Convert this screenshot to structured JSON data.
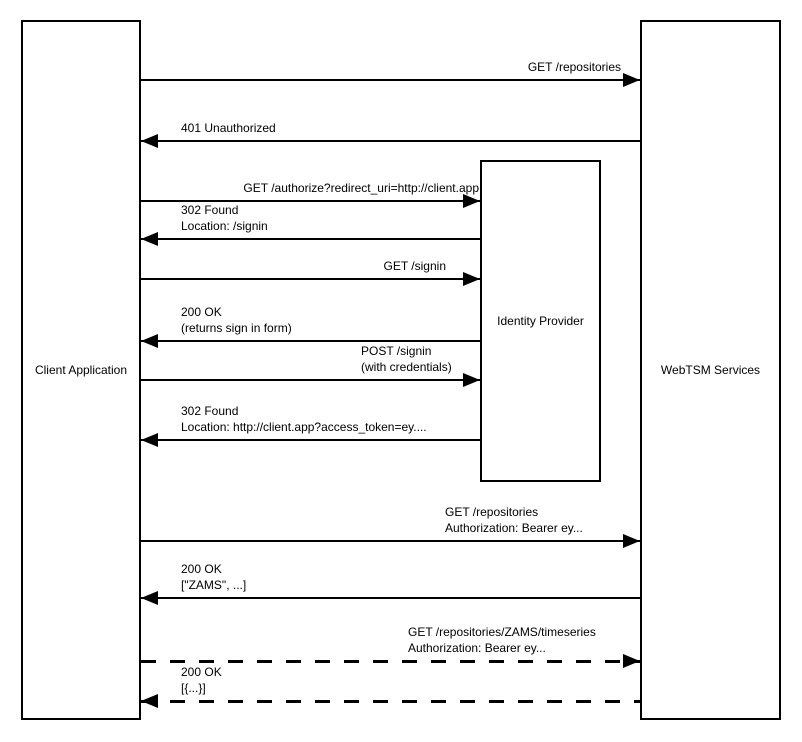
{
  "canvas": {
    "width": 802,
    "height": 742,
    "background": "#ffffff",
    "line_color": "#000000",
    "text_color": "#000000"
  },
  "diagram": {
    "type": "sequence",
    "actors": [
      {
        "id": "client-application",
        "label": "Client Application",
        "x": 21,
        "y": 20,
        "w": 120,
        "h": 700
      },
      {
        "id": "identity-provider",
        "label": "Identity Provider",
        "x": 480,
        "y": 160,
        "w": 121,
        "h": 322
      },
      {
        "id": "webtsm-services",
        "label": "WebTSM Services",
        "x": 640,
        "y": 20,
        "w": 141,
        "h": 700
      }
    ],
    "messages": [
      {
        "from": "client-application",
        "to": "webtsm-services",
        "lines": [
          "GET /repositories"
        ],
        "y": 80,
        "x1": 141,
        "x2": 640,
        "dir": "right",
        "style": "solid",
        "align": "right",
        "label_x": 621
      },
      {
        "from": "webtsm-services",
        "to": "client-application",
        "lines": [
          "401 Unauthorized"
        ],
        "y": 141,
        "x1": 141,
        "x2": 640,
        "dir": "left",
        "style": "solid",
        "align": "left",
        "label_x": 181
      },
      {
        "from": "client-application",
        "to": "identity-provider",
        "lines": [
          "GET /authorize?redirect_uri=http://client.app"
        ],
        "y": 201,
        "x1": 141,
        "x2": 480,
        "dir": "right",
        "style": "solid",
        "align": "right",
        "label_x": 479
      },
      {
        "from": "identity-provider",
        "to": "client-application",
        "lines": [
          "302 Found",
          "Location: /signin"
        ],
        "y": 239,
        "x1": 141,
        "x2": 480,
        "dir": "left",
        "style": "solid",
        "align": "left",
        "label_x": 181
      },
      {
        "from": "client-application",
        "to": "identity-provider",
        "lines": [
          "GET /signin"
        ],
        "y": 279,
        "x1": 141,
        "x2": 480,
        "dir": "right",
        "style": "solid",
        "align": "right",
        "label_x": 446
      },
      {
        "from": "identity-provider",
        "to": "client-application",
        "lines": [
          "200 OK",
          "(returns sign in form)"
        ],
        "y": 341,
        "x1": 141,
        "x2": 480,
        "dir": "left",
        "style": "solid",
        "align": "left",
        "label_x": 181
      },
      {
        "from": "client-application",
        "to": "identity-provider",
        "lines": [
          "POST /signin",
          "(with credentials)"
        ],
        "y": 380,
        "x1": 141,
        "x2": 480,
        "dir": "right",
        "style": "solid",
        "align": "left",
        "label_x": 361
      },
      {
        "from": "identity-provider",
        "to": "client-application",
        "lines": [
          "302 Found",
          "Location: http://client.app?access_token=ey...."
        ],
        "y": 440,
        "x1": 141,
        "x2": 480,
        "dir": "left",
        "style": "solid",
        "align": "left",
        "label_x": 181
      },
      {
        "from": "client-application",
        "to": "webtsm-services",
        "lines": [
          "GET /repositories",
          "Authorization: Bearer ey..."
        ],
        "y": 541,
        "x1": 141,
        "x2": 640,
        "dir": "right",
        "style": "solid",
        "align": "left",
        "label_x": 445
      },
      {
        "from": "webtsm-services",
        "to": "client-application",
        "lines": [
          "200 OK",
          "[\"ZAMS\", ...]"
        ],
        "y": 598,
        "x1": 141,
        "x2": 640,
        "dir": "left",
        "style": "solid",
        "align": "left",
        "label_x": 181
      },
      {
        "from": "client-application",
        "to": "webtsm-services",
        "lines": [
          "GET /repositories/ZAMS/timeseries",
          "Authorization: Bearer ey..."
        ],
        "y": 661,
        "x1": 141,
        "x2": 640,
        "dir": "right",
        "style": "dashed",
        "align": "left",
        "label_x": 408
      },
      {
        "from": "webtsm-services",
        "to": "client-application",
        "lines": [
          "200 OK",
          "[{...}]"
        ],
        "y": 701,
        "x1": 141,
        "x2": 640,
        "dir": "left",
        "style": "dashed",
        "align": "left",
        "label_x": 181
      }
    ]
  }
}
